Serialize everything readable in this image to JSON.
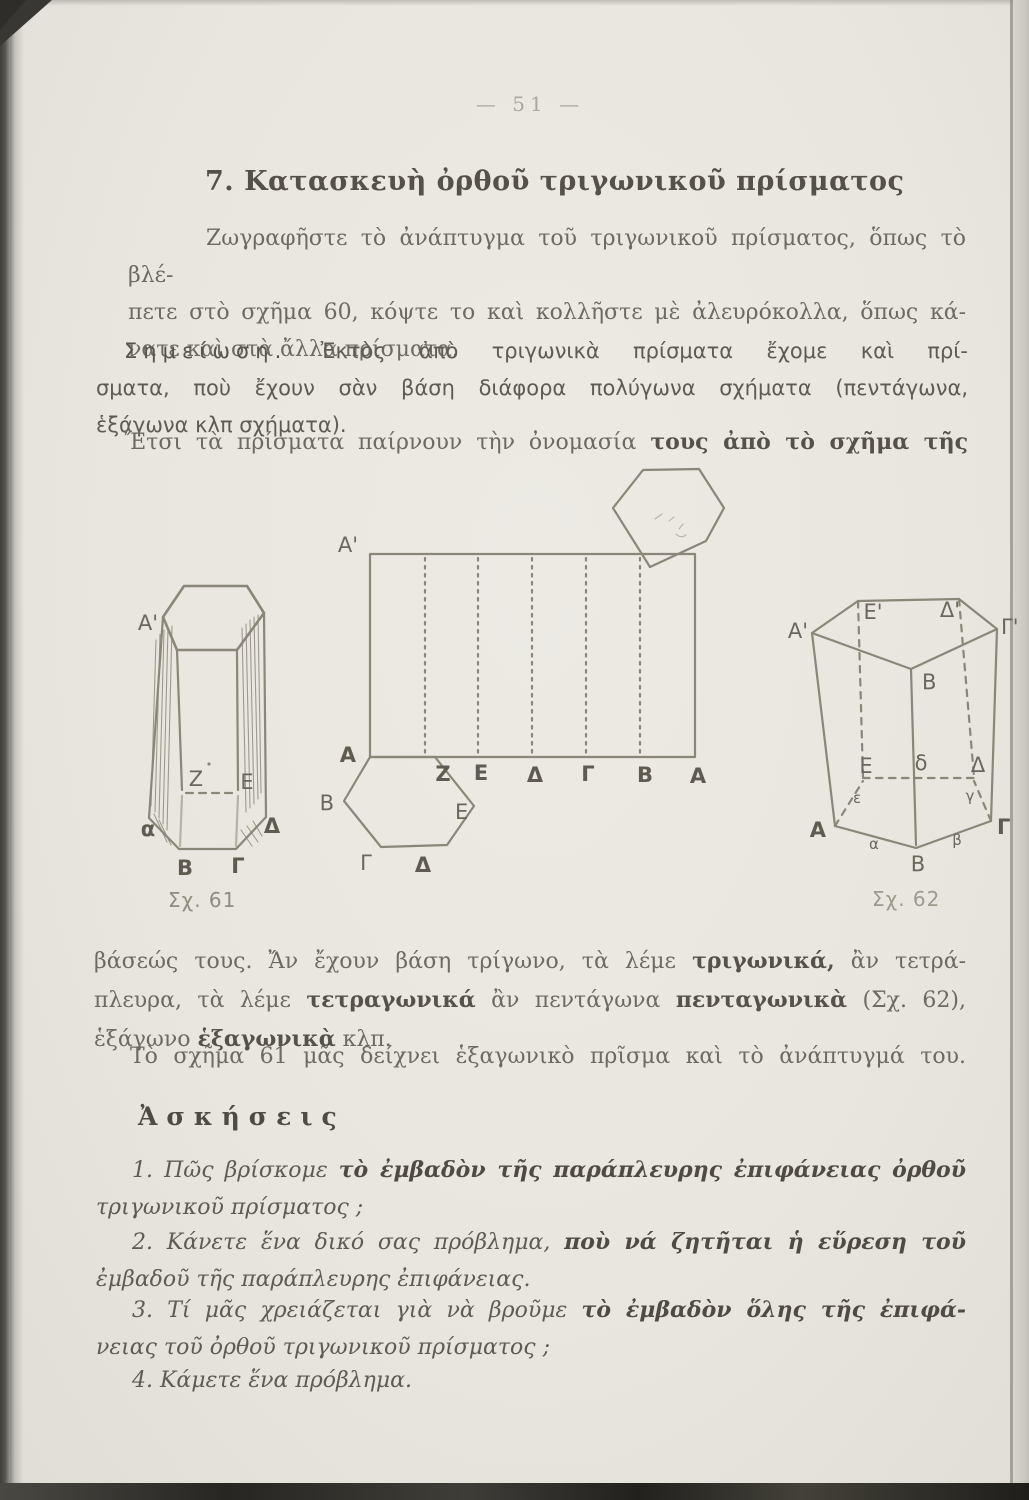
{
  "page": {
    "number": "— 51 —"
  },
  "heading": {
    "text": "7. Κατασκευὴ ὀρθοῦ τριγωνικοῦ πρίσματος"
  },
  "body": {
    "p1": {
      "lines": [
        "Ζωγραφῆστε τὸ ἀνάπτυγμα τοῦ τριγωνικοῦ πρίσματος, ὅπως τὸ βλέ-",
        "πετε στὸ σχῆμα 60, κόψτε το καὶ κολλῆστε μὲ ἀλευρόκολλα, ὅπως κά-",
        "νατε καὶ στὰ ἄλλα πρίσματα."
      ]
    },
    "note": {
      "label": "Σημείωση.",
      "l1rest": " Ἐκτὸς ἀπὸ τριγωνικὰ πρίσματα ἔχομε καὶ πρί-",
      "l2": "σματα, ποὺ ἔχουν σὰν βάση διάφορα πολύγωνα σχήματα (πεντάγωνα,",
      "l3": "ἑξάγωνα κλπ σχήματα)."
    },
    "p3a": "Ἔτσι τὰ πρίσματα παίρνουν τὴν ὀνομασία ",
    "p3b": "τους ἀπὸ τὸ σχῆμα τῆς",
    "p4": {
      "l1a": "βάσεώς τους. Ἄν ἔχουν βάση τρίγωνο, τὰ λέμε ",
      "l1b": "τριγωνικά,",
      "l1c": " ἂν τετρά-",
      "l2a": "πλευρα, τὰ λέμε ",
      "l2b": "τετραγωνικά",
      "l2c": " ἂν πεντάγωνα ",
      "l2d": "πενταγωνικὰ",
      "l2e": " (Σχ. 62),",
      "l3a": "ἑξάγωνο ",
      "l3b": "ἑξαγωνικὰ",
      "l3c": " κλπ."
    },
    "p5": "Τὸ σχῆμα 61 μᾶς δείχνει ἑξαγωνικὸ πρῖσμα καὶ τὸ ἀνάπτυγμά του."
  },
  "exercises": {
    "heading": "Ἀσκήσεις",
    "ex1": {
      "l1a": "1. Πῶς βρίσκομε ",
      "l1b": "τὸ ἐμβαδὸν τῆς παράπλευρης ἐπιφάνειας ὀρθοῦ",
      "l2": "τριγωνικοῦ πρίσματος ;"
    },
    "ex2": {
      "l1a": "2. Κάνετε ἕνα δικό σας πρόβλημα, ",
      "l1b": "ποὺ νά ζητῆται ἡ εὕρεση τοῦ",
      "l2": "ἐμβαδοῦ τῆς παράπλευρης ἐπιφάνειας."
    },
    "ex3": {
      "l1a": "3. Τί μᾶς χρειάζεται γιὰ νὰ βροῦμε ",
      "l1b": "τὸ ἐμβαδὸν ὅλης τῆς ἐπιφά-",
      "l2": "νειας τοῦ ὀρθοῦ τριγωνικοῦ πρίσματος ;"
    },
    "ex4": {
      "l1": "4. Κάμετε ἕνα πρόβλημα."
    }
  },
  "figures": {
    "fig61": {
      "caption": "Σχ. 61",
      "labels": {
        "a_top": "Α'",
        "z": "Ζ",
        "e": "Ε",
        "a": "α",
        "delta": "Δ",
        "b": "Β",
        "gamma": "Γ"
      }
    },
    "net": {
      "labels": {
        "a_top": "Α'",
        "a_left": "Α",
        "z": "Ζ",
        "e": "Ε",
        "delta": "Δ",
        "gamma": "Γ",
        "b": "Β",
        "a_right": "Α",
        "hex_b": "Β",
        "hex_e": "Ε",
        "hex_gamma": "Γ",
        "hex_delta": "Δ"
      }
    },
    "fig62": {
      "caption": "Σχ. 62",
      "labels": {
        "a_t": "Α'",
        "e_t": "Ε'",
        "d_t": "Δ'",
        "g_t": "Γ'",
        "b_t": "Β",
        "e_m": "Ε",
        "d_small": "δ",
        "d_m": "Δ",
        "eps": "ε",
        "gam_small": "γ",
        "a_b": "Α",
        "g_b": "Γ",
        "b_b": "Β",
        "alpha": "α",
        "beta": "β"
      }
    }
  },
  "colors": {
    "page_bg": "#e9e6df",
    "ink": "#6b675e",
    "ink_dark": "#4f4b43",
    "figure_stroke": "#8a8678",
    "caption": "#8f8c80",
    "scan_edge_dark": "#383734"
  }
}
